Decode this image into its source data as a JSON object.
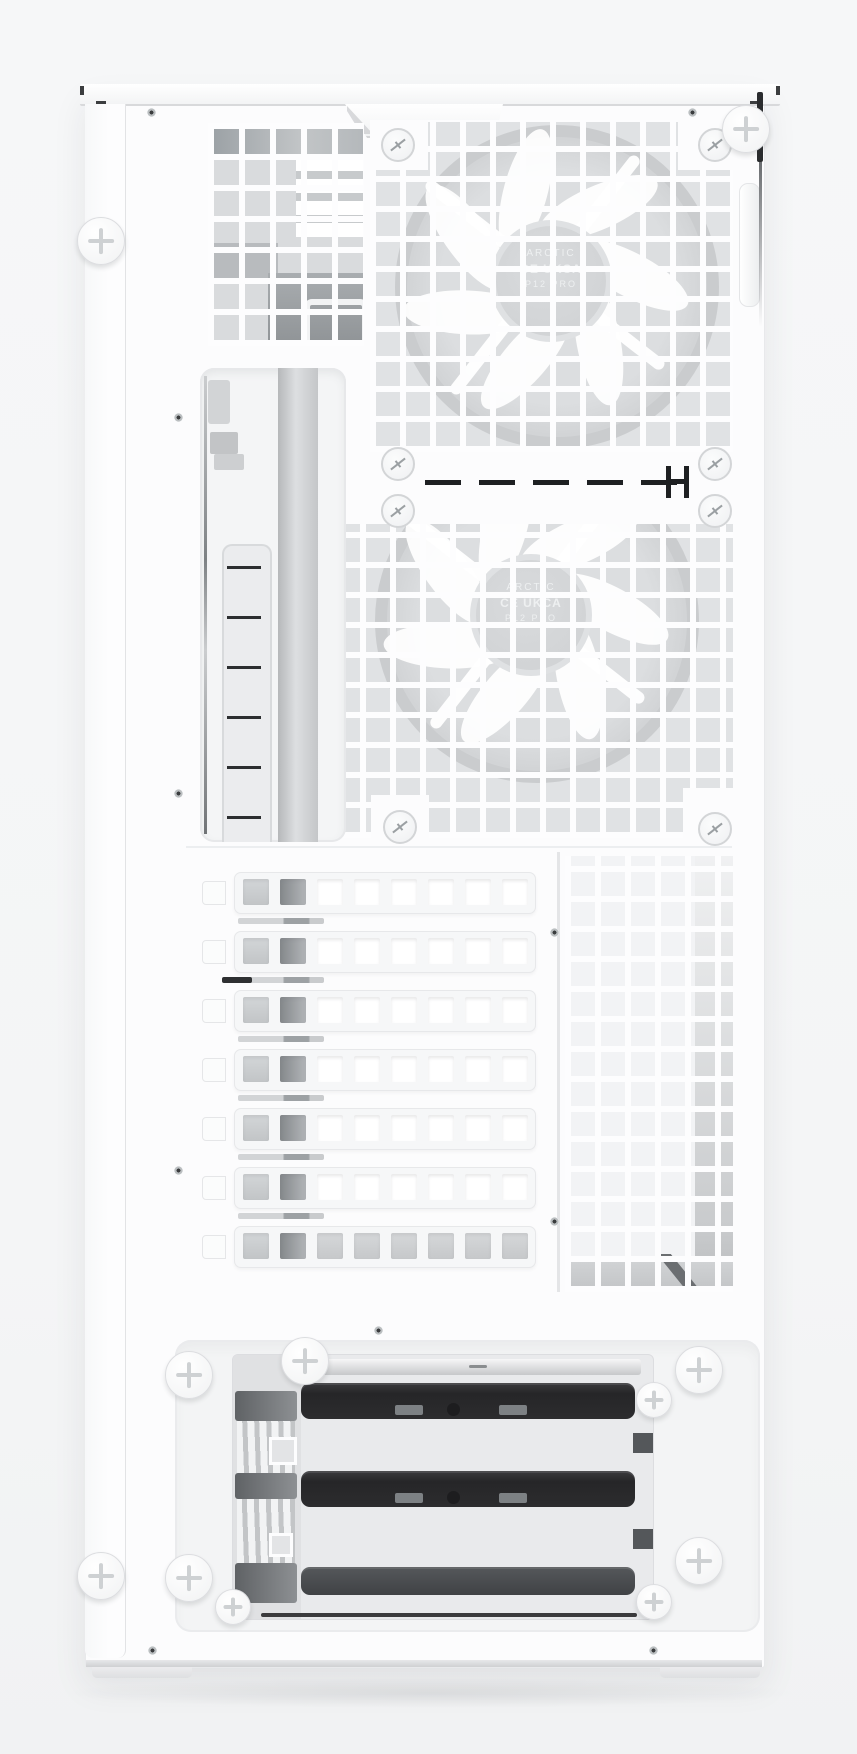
{
  "photo": {
    "subject": "White mid-tower PC case, panel view with mesh vents, two fans, expansion slots and drive cage",
    "background_color": "#f5f6f7",
    "case_color": "#fcfcfd",
    "mesh_line_color": "#fdfdfe"
  },
  "fans": {
    "count": 2,
    "hub": {
      "brand": "ARCTIC",
      "cert": "CE UKCA",
      "model": "P12 PRO"
    },
    "frame_color": "#caccce",
    "blade_color": "#ffffff"
  },
  "expansion_slots": {
    "count": 7,
    "vents_per_cover": 8,
    "cover_color": "#f6f7f8"
  },
  "drive_cage": {
    "tray_count": 3,
    "tray_color": "#2c2c2e",
    "frame_color": "#e9eaec"
  },
  "hardware": {
    "thumbscrew_count": 11,
    "fan_screw_count": 8,
    "bracket_slot_ticks": 6
  }
}
